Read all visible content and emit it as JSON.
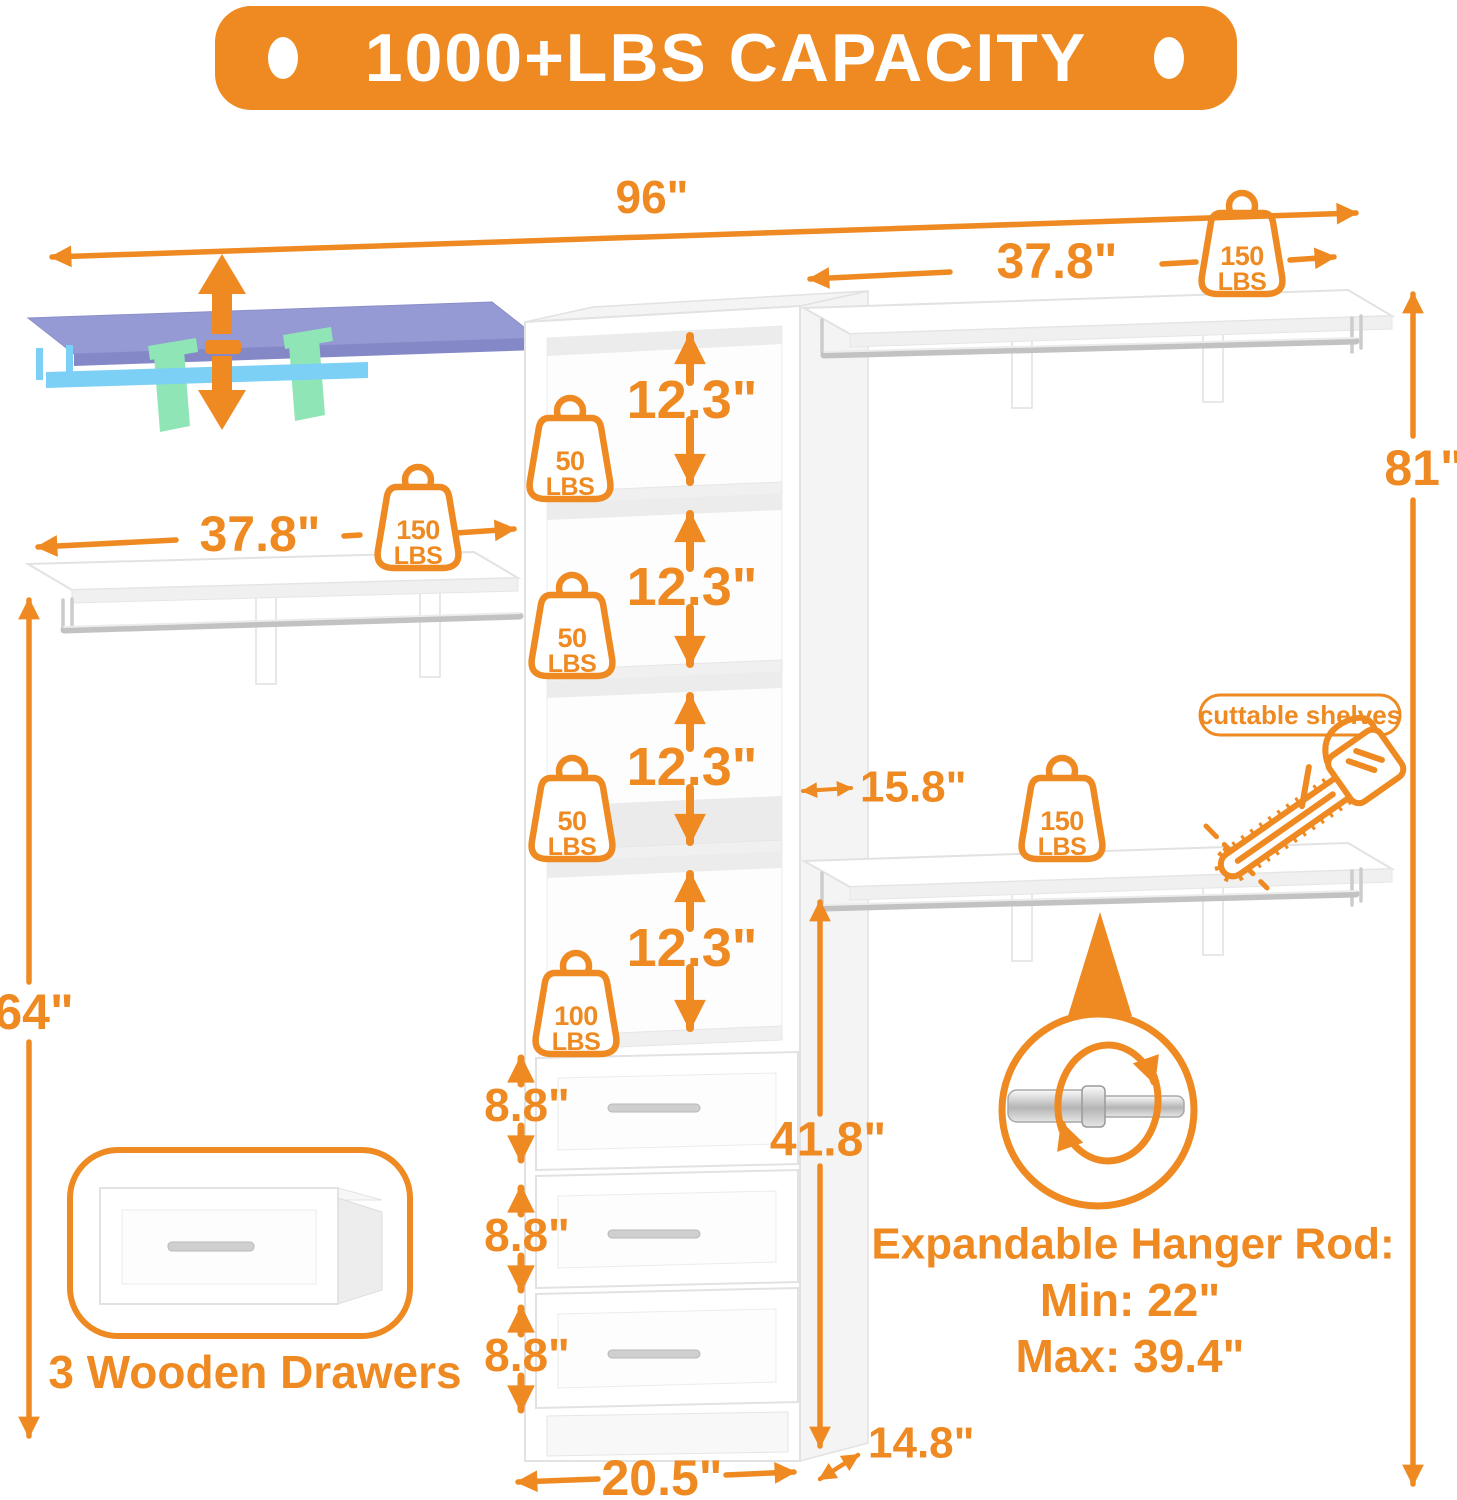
{
  "banner": {
    "label": "1000+LBS CAPACITY"
  },
  "colors": {
    "accent": "#EE8A21",
    "shelf_purple": "#9599D4",
    "rod_blue": "#7CD0F5",
    "bracket_green": "#8FE5B5"
  },
  "dims": {
    "overall_width": "96\"",
    "top_shelf_width": "37.8\"",
    "left_shelf_width": "37.8\"",
    "right_height": "81\"",
    "left_height": "64\"",
    "shelf_gaps": [
      "12.3\"",
      "12.3\"",
      "12.3\"",
      "12.3\""
    ],
    "cubby_width": "15.8\"",
    "drawer_stack_height": "41.8\"",
    "drawer_gaps": [
      "8.8\"",
      "8.8\"",
      "8.8\""
    ],
    "tower_width": "20.5\"",
    "depth": "14.8\""
  },
  "badges": {
    "top_right": {
      "value": "150",
      "unit": "LBS"
    },
    "left": {
      "value": "150",
      "unit": "LBS"
    },
    "shelf1": {
      "value": "50",
      "unit": "LBS"
    },
    "shelf2": {
      "value": "50",
      "unit": "LBS"
    },
    "shelf3": {
      "value": "50",
      "unit": "LBS"
    },
    "shelf4": {
      "value": "100",
      "unit": "LBS"
    },
    "bottom_right": {
      "value": "150",
      "unit": "LBS"
    }
  },
  "callouts": {
    "cuttable_shelves": "cuttable shelves",
    "hanger_title": "Expandable Hanger Rod:",
    "hanger_min": "Min: 22\"",
    "hanger_max": "Max: 39.4\"",
    "drawers_caption": "3 Wooden Drawers"
  }
}
